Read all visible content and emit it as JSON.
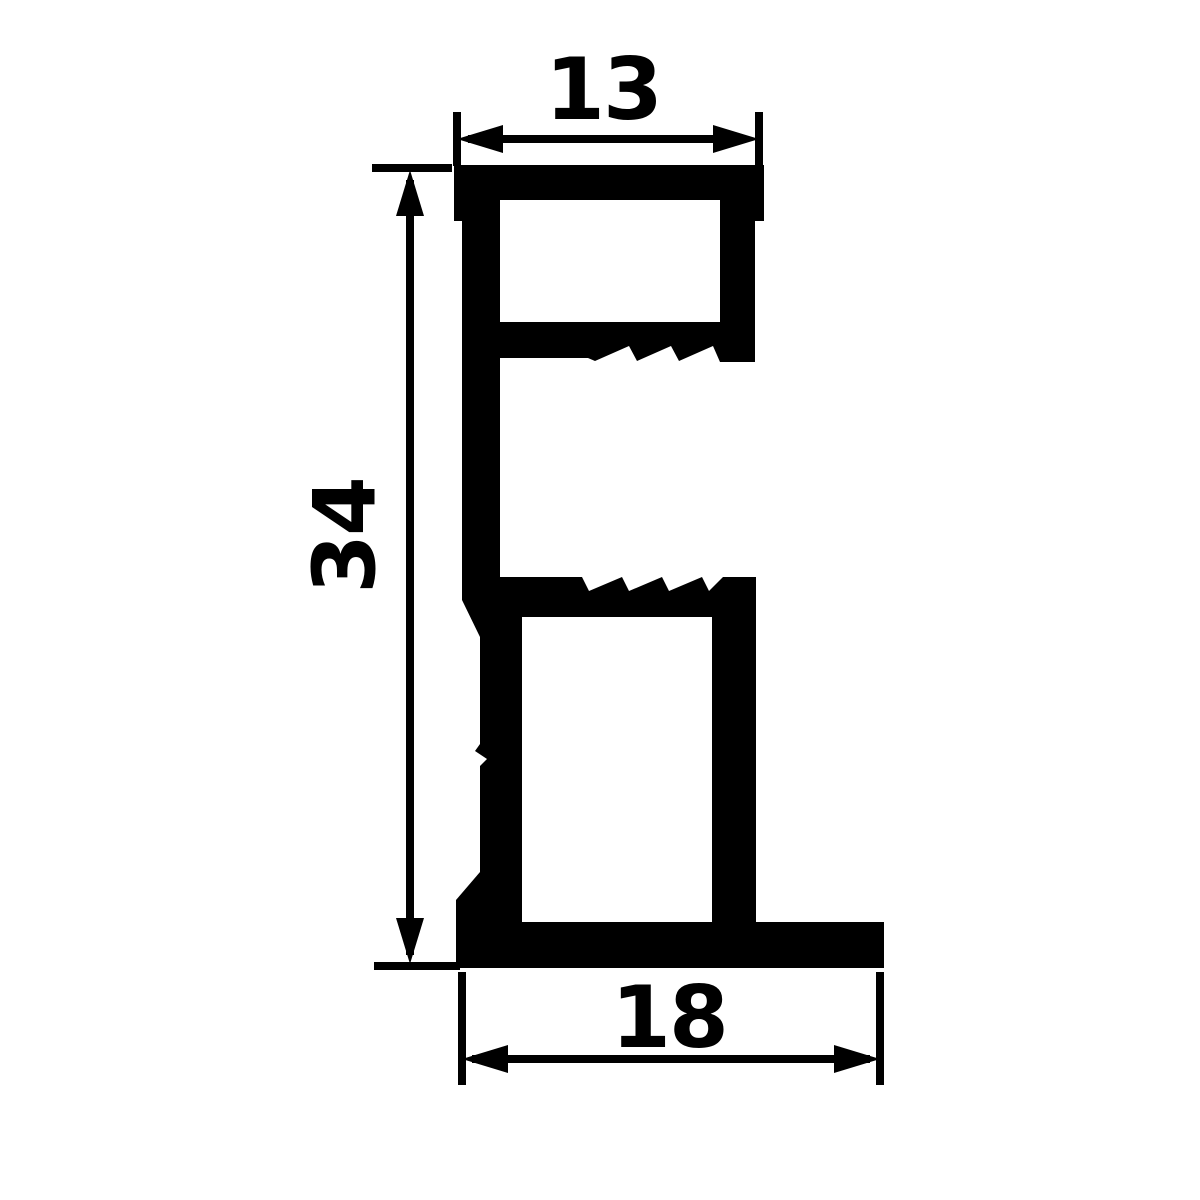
{
  "drawing": {
    "kind": "profile-cross-section-dimension-drawing",
    "dimensions": {
      "top_width": {
        "value": "13"
      },
      "left_height": {
        "value": "34"
      },
      "bottom_width": {
        "value": "18"
      }
    },
    "colors": {
      "ink": "#000000",
      "background": "#ffffff"
    }
  }
}
